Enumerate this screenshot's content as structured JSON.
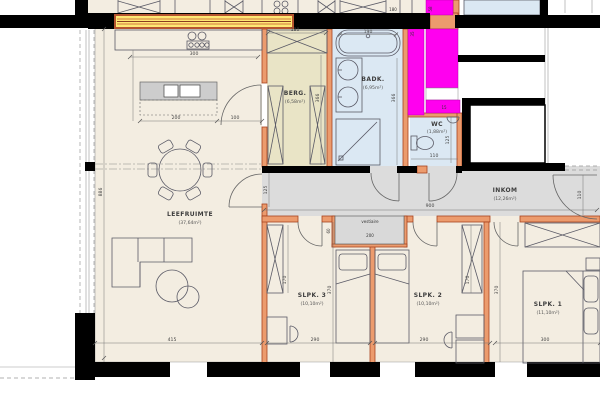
{
  "floorplan": {
    "rooms": {
      "leefruimte": {
        "name": "LEEFRUIMTE",
        "area": "(37,64m²)"
      },
      "berg": {
        "name": "BERG.",
        "area": "(6,58m²)"
      },
      "badk": {
        "name": "BADK.",
        "area": "(6,95m²)"
      },
      "wc": {
        "name": "WC",
        "area": "(1,88m²)"
      },
      "inkom": {
        "name": "INKOM",
        "area": "(12,26m²)"
      },
      "slpk3": {
        "name": "SLPK. 3",
        "area": "(10,10m²)"
      },
      "slpk2": {
        "name": "SLPK. 2",
        "area": "(10,10m²)"
      },
      "slpk1": {
        "name": "SLPK. 1",
        "area": "(11,10m²)"
      }
    },
    "labels": {
      "vestiaire": "vestiaire"
    },
    "dims": {
      "kitchen_counter": "300",
      "island": "200",
      "island_gap": "100",
      "living_width": "415",
      "living_depth": "886",
      "hall_length": "900",
      "hall_door": "125",
      "entrance": "110",
      "berg_width": "180",
      "berg_depth": "366",
      "tub": "190",
      "badk_depth": "366",
      "wc_width": "110",
      "wc_depth": "125",
      "slpk3_width": "290",
      "slpk2_width": "290",
      "slpk1_width": "300",
      "slpk3_depth": "370",
      "slpk1_depth": "370",
      "wardrobe3": "170",
      "wardrobe2": "170",
      "vest_w": "200",
      "vest_d": "60",
      "m35": "35",
      "m15": "15",
      "m58": "58",
      "top_180": "180"
    },
    "colors": {
      "floor": "#f3ede1",
      "hall": "#dcdcdc",
      "wet": "#dbe8f3",
      "storage": "#e9e4c6",
      "wall_new": "#ff00ef",
      "wall_accent": "#ec9b6d",
      "beam": "#ffe873",
      "structure": "#000000"
    }
  }
}
